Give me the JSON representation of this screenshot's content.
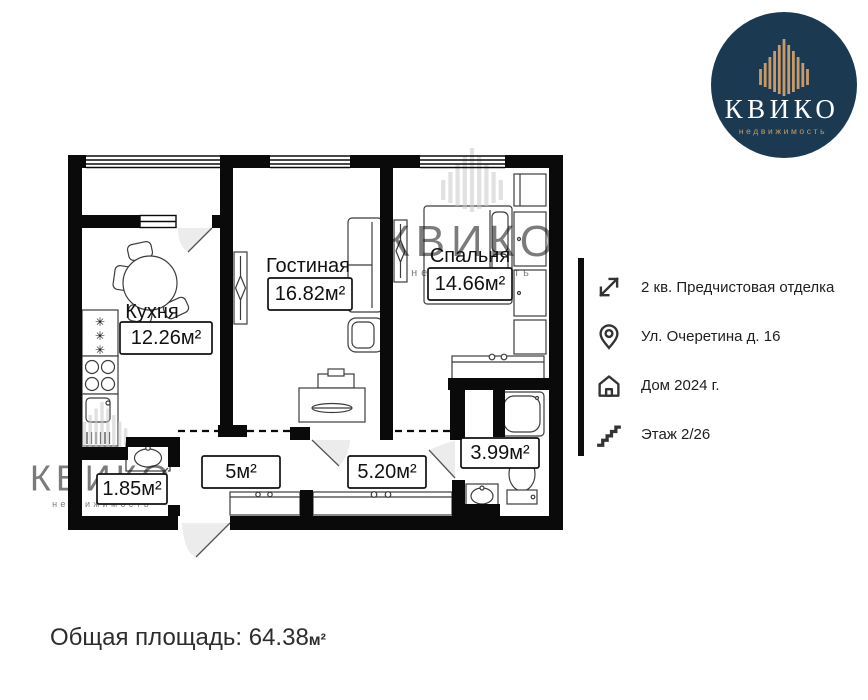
{
  "logo": {
    "brand": "КВИКО",
    "tagline": "недвижимость"
  },
  "colors": {
    "logo_background": "#1b3a52",
    "logo_accent": "#c79a6a",
    "wall": "#0a0a0a",
    "watermark": "#c9c9c9"
  },
  "info_panel": {
    "items": [
      {
        "icon": "expand-arrows-icon",
        "label": "2 кв. Предчистовая отделка"
      },
      {
        "icon": "location-pin-icon",
        "label": "Ул. Очеретина д. 16"
      },
      {
        "icon": "house-icon",
        "label": "Дом 2024 г."
      },
      {
        "icon": "stairs-icon",
        "label": "Этаж 2/26"
      }
    ]
  },
  "floor_plan": {
    "watermark": "КВИКО",
    "watermark_tagline": "недвижимость",
    "rooms": [
      {
        "name": "Кухня",
        "area": "12.26м²"
      },
      {
        "name": "Гостиная",
        "area": "16.82м²"
      },
      {
        "name": "Спальня",
        "area": "14.66м²"
      },
      {
        "name": "",
        "area": "5м²"
      },
      {
        "name": "",
        "area": "5.20м²"
      },
      {
        "name": "",
        "area": "3.99м²"
      },
      {
        "name": "",
        "area": "1.85м²"
      }
    ]
  },
  "footer": {
    "total_area_label": "Общая площадь:",
    "total_area_value": " 64.38",
    "total_area_unit": "м²"
  }
}
